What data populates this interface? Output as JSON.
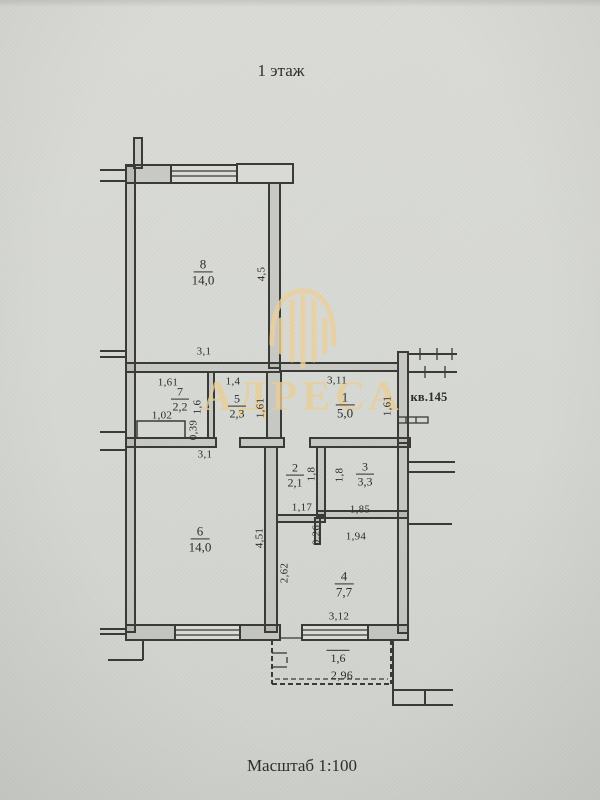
{
  "title": "1 этаж",
  "scale_label": "Масштаб 1:100",
  "apartment_label": "кв.145",
  "watermark_text": "АДРЕСА",
  "colors": {
    "paper": "#d7d8d4",
    "line": "#3a3a37",
    "watermark_gold": "#ecd09a"
  },
  "rooms": {
    "r8": {
      "num": "8",
      "area": "14,0"
    },
    "r7": {
      "num": "7",
      "area": "2,2"
    },
    "r5": {
      "num": "5",
      "area": "2,3"
    },
    "r1": {
      "num": "1",
      "area": "5,0"
    },
    "r6": {
      "num": "6",
      "area": "14,0"
    },
    "r2": {
      "num": "2",
      "area": "2,1"
    },
    "r3": {
      "num": "3",
      "area": "3,3"
    },
    "r4": {
      "num": "4",
      "area": "7,7"
    }
  },
  "balcony": {
    "area": "1,6",
    "width": "2,96"
  },
  "dims": {
    "room8_height": "4,5",
    "room8_width": "3,1",
    "hall7_top": "1,61",
    "hall5_top": "1,4",
    "hall1_top": "3,11",
    "hall7_height": "1,6",
    "hall5_height": "1,61",
    "hall1_height": "1,61",
    "closet_width": "1,02",
    "closet_depth": "0,39",
    "room6_top": "3,1",
    "room6_height": "4,51",
    "room2_height": "1,8",
    "room3_height": "1,8",
    "room2_width": "1,17",
    "room3_width": "1,85",
    "step_height": "0,26",
    "room4_top_width": "1,94",
    "room4_left_height": "2,62",
    "room4_width": "3,12"
  }
}
